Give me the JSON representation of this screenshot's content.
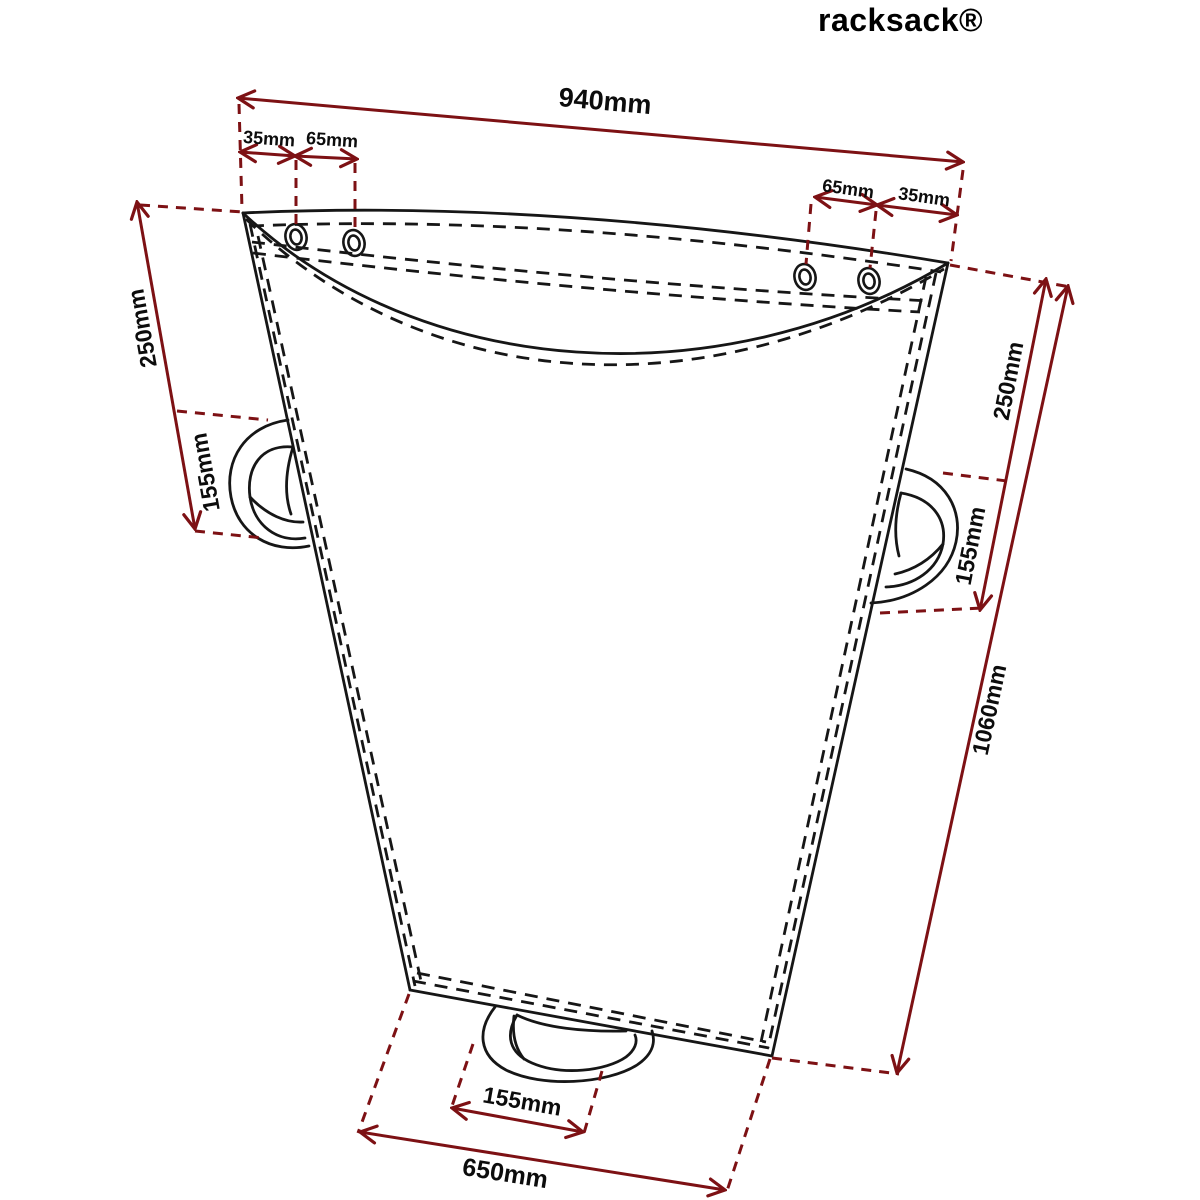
{
  "title": "racksack®",
  "colors": {
    "dimension_red": "#7d1114",
    "outline_black": "#161616",
    "background": "#ffffff"
  },
  "drawing": {
    "description": "Technical dimension drawing of a racksack waste sack shown in perspective with eyelets, side handles and a bottom handle",
    "labels": [
      {
        "text": "940mm",
        "meaning": "overall top width"
      },
      {
        "text": "35mm",
        "meaning": "top-left corner to first eyelet"
      },
      {
        "text": "65mm",
        "meaning": "left eyelet spacing"
      },
      {
        "text": "65mm",
        "meaning": "right eyelet spacing"
      },
      {
        "text": "35mm",
        "meaning": "last eyelet to top-right corner"
      },
      {
        "text": "250mm",
        "meaning": "left top edge down to handle"
      },
      {
        "text": "155mm",
        "meaning": "left handle opening height"
      },
      {
        "text": "250mm",
        "meaning": "right top edge down to handle"
      },
      {
        "text": "155mm",
        "meaning": "right handle opening height"
      },
      {
        "text": "1060mm",
        "meaning": "overall side height"
      },
      {
        "text": "155mm",
        "meaning": "bottom handle opening width"
      },
      {
        "text": "650mm",
        "meaning": "overall bottom width"
      }
    ]
  }
}
